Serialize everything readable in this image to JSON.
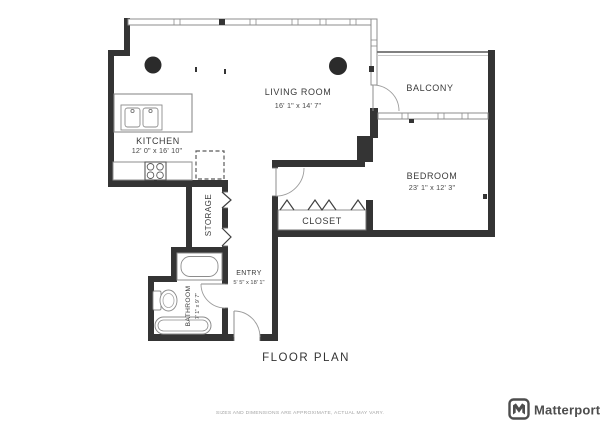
{
  "rooms": {
    "living_room": {
      "name": "LIVING ROOM",
      "dims": "16' 1\" x 14' 7\""
    },
    "kitchen": {
      "name": "KITCHEN",
      "dims": "12' 0\" x 16' 10\""
    },
    "balcony": {
      "name": "BALCONY"
    },
    "bedroom": {
      "name": "BEDROOM",
      "dims": "23' 1\" x 12' 3\""
    },
    "closet": {
      "name": "CLOSET"
    },
    "storage": {
      "name": "STORAGE"
    },
    "bathroom": {
      "name": "BATHROOM",
      "dims": "7' 1\" x 9' 7\""
    },
    "entry": {
      "name": "ENTRY",
      "dims": "5' 5\" x 18' 1\""
    }
  },
  "footer": {
    "title": "FLOOR PLAN",
    "disclaimer": "SIZES AND DIMENSIONS ARE APPROXIMATE, ACTUAL MAY VARY."
  },
  "brand": {
    "name": "Matterport"
  },
  "colors": {
    "wall": "#343434",
    "thin_line": "#8c8c8c",
    "label": "#3a3a3a",
    "footer_text": "#a3a3a3",
    "brand_text": "#4d4d4d",
    "background": "#ffffff"
  }
}
